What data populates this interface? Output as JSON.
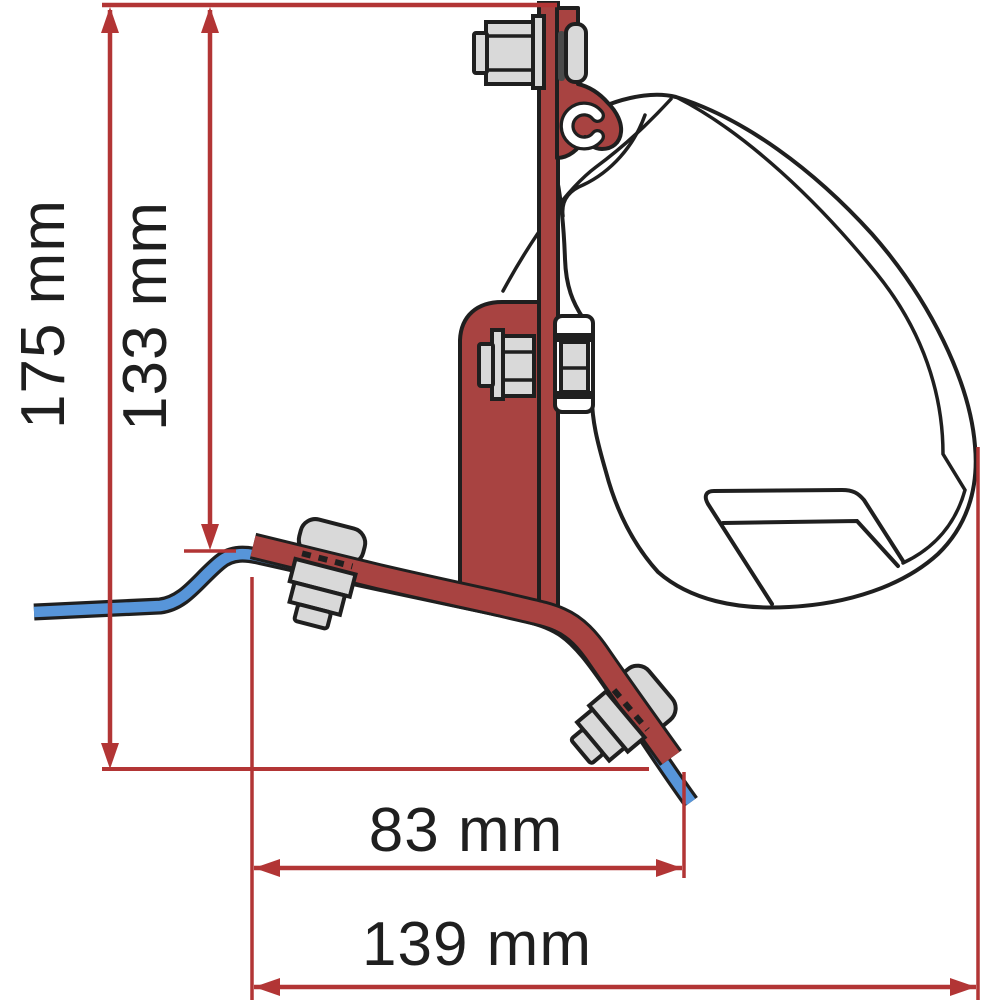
{
  "diagram": {
    "title": "Awning bracket mounting dimension diagram",
    "dimensions": {
      "total_height": {
        "label": "175 mm",
        "orientation": "vertical"
      },
      "bracket_height": {
        "label": "133 mm",
        "orientation": "vertical"
      },
      "inner_width": {
        "label": "83 mm",
        "orientation": "horizontal"
      },
      "total_width": {
        "label": "139 mm",
        "orientation": "horizontal"
      }
    },
    "parts": [
      "vertical bracket plate",
      "top mounting hook",
      "awning case profile",
      "awning rail bead",
      "vehicle roof line",
      "diagonal roof bracket",
      "clamp bolts"
    ],
    "colors": {
      "bracket_red": "#a84341",
      "dimension_red": "#b23535",
      "roof_blue": "#5795d9",
      "outline": "#1f1f1f",
      "metal_grey": "#d9d9d9",
      "background": "#ffffff"
    }
  }
}
